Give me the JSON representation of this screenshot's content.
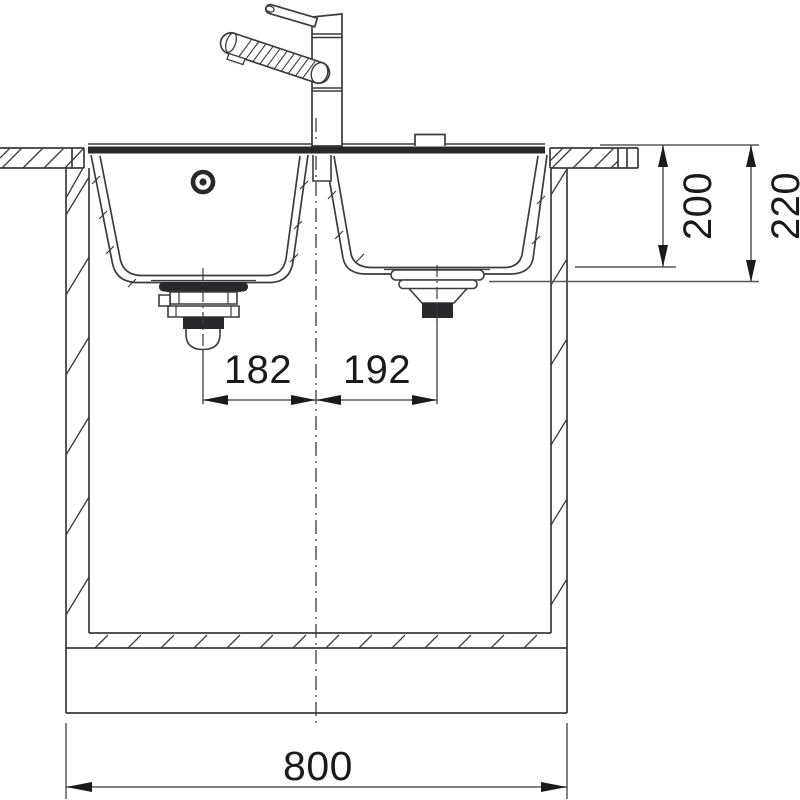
{
  "diagram": {
    "type": "kitchen-sink-installation-cross-section",
    "dimensions": {
      "bowl_depth": "200",
      "total_depth": "220",
      "left_drain_offset": "182",
      "right_drain_offset": "192",
      "overall_width": "800"
    },
    "colors": {
      "line": "#3b3b3d",
      "dim_line": "#58585a",
      "text": "#1a1a1a",
      "dark_fill": "#28282a",
      "background": "#ffffff"
    }
  }
}
